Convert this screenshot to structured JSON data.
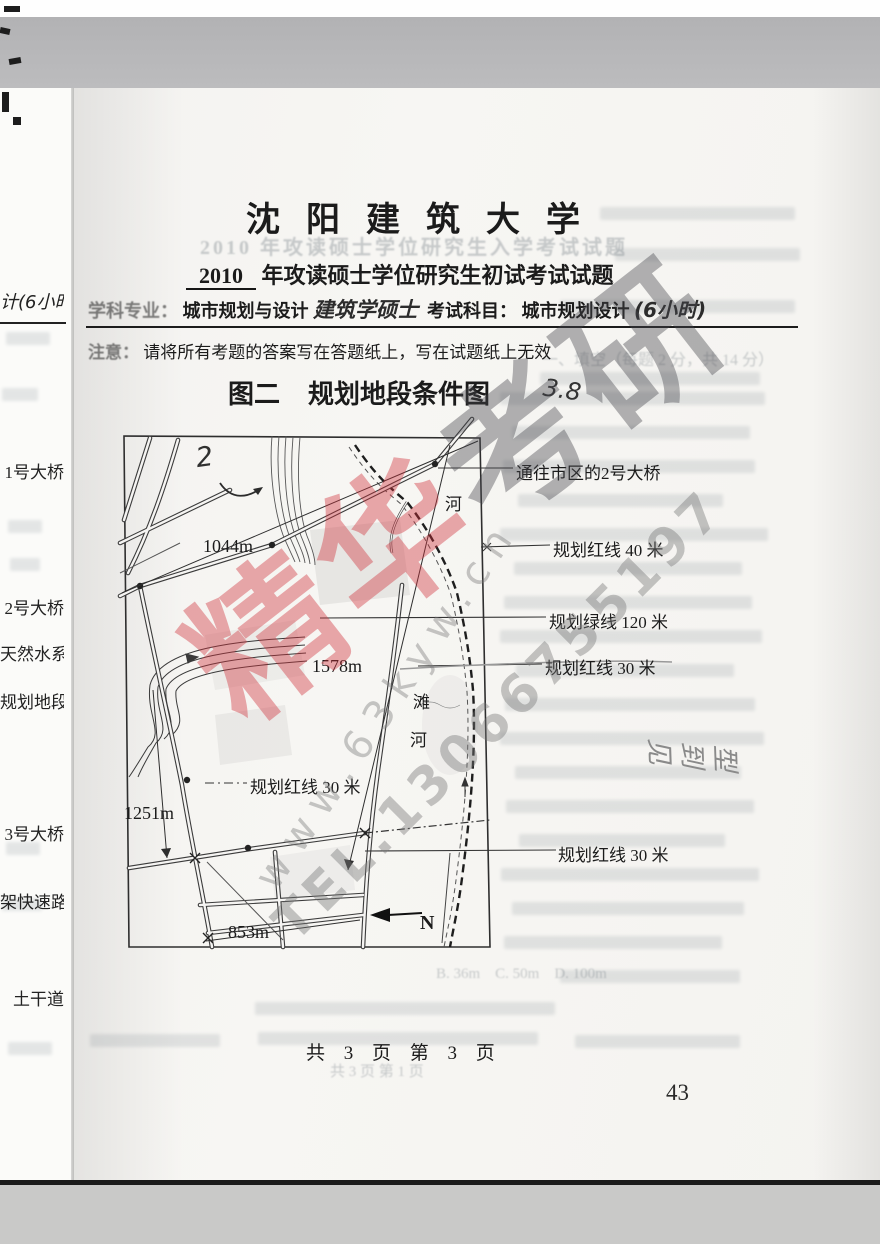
{
  "header": {
    "university": "沈阳建筑大学",
    "year": "2010",
    "title_rest": "年攻读硕士学位研究生初试考试试题",
    "major_label": "学科专业：",
    "major_value": "城市规划与设计",
    "major_handwritten": "建筑学硕士",
    "subject_label": "考试科目：",
    "subject_value": "城市规划设计",
    "subject_handwritten": "(6小时)",
    "notice_label": "注意：",
    "notice_text": "请将所有考题的答案写在答题纸上，写在试题纸上无效"
  },
  "figure": {
    "title_prefix": "图二",
    "title": "规划地段条件图",
    "bridge_label": "通往市区的2号大桥",
    "redline40": "规划红线 40 米",
    "greenline120": "规划绿线 120 米",
    "redline30_a": "规划红线 30 米",
    "redline30_b": "规划红线 30 米",
    "redline30_inner": "规划红线 30 米",
    "dim_1044": "1044m",
    "dim_1578": "1578m",
    "dim_1251": "1251m",
    "dim_853": "853m",
    "river_char_top": "河",
    "beach_char": "滩",
    "river_char_bottom": "河",
    "north_label": "N",
    "hw_mark": "3.8",
    "hw_two": "2",
    "hw_margin_note": "见到型"
  },
  "watermark": {
    "brand_red": "精华",
    "brand_dark": "考研",
    "site": "www.63kyw.cn",
    "phone": "TEL.13066755197"
  },
  "adjacent": {
    "a0": "计(6小时)",
    "a1": "1号大桥",
    "a2": "2号大桥",
    "a3": "天然水系",
    "a4": "规划地段",
    "a5": "3号大桥",
    "a6": "架快速路",
    "a7": "土干道"
  },
  "ghost": {
    "g1": "2010 年攻读硕士学位研究生入学考试试题",
    "g2": "一、填空（每题 2 分，共 14 分）",
    "g3": "B. 36m　C. 50m　D. 100m",
    "g4": "共 3 页 第 1 页"
  },
  "footer": {
    "text": "共 3 页 第 3 页",
    "page_number": "43"
  }
}
